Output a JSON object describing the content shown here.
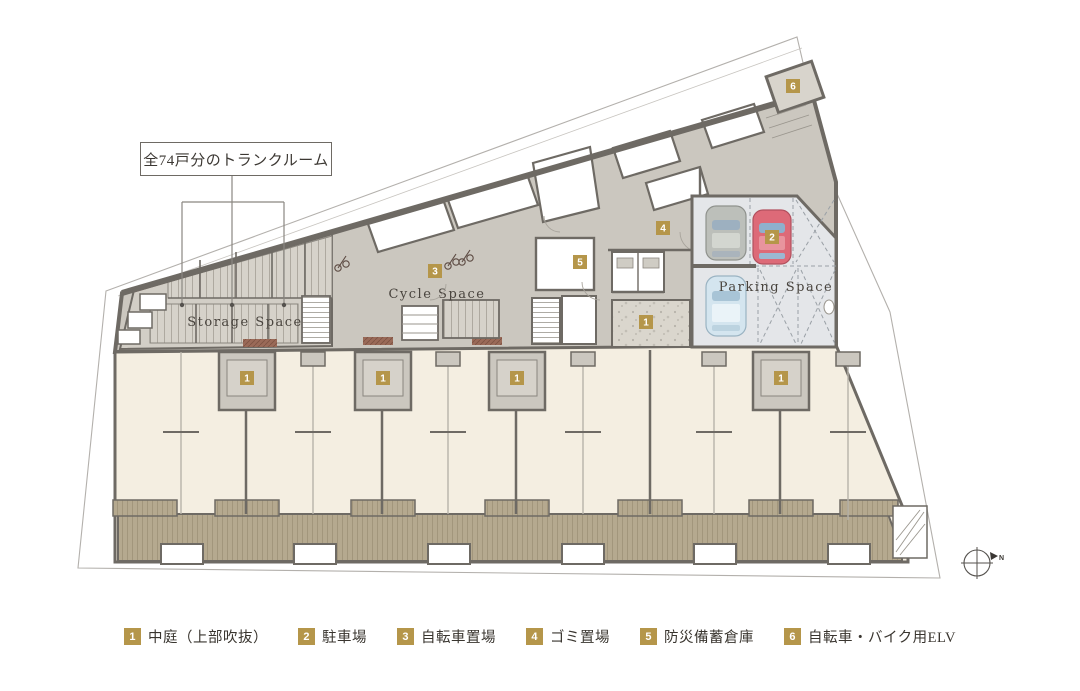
{
  "annotation": {
    "label": "全74戸分のトランクルーム"
  },
  "areas": {
    "storage": "Storage Space",
    "cycle": "Cycle Space",
    "parking": "Parking Space"
  },
  "markers": {
    "courtyard_main": "1",
    "unit_courtyard": "1",
    "parking": "2",
    "cycle": "3",
    "garbage": "4",
    "disaster": "5",
    "elv": "6"
  },
  "legend": {
    "items": [
      {
        "num": "1",
        "label": "中庭（上部吹抜）"
      },
      {
        "num": "2",
        "label": "駐車場"
      },
      {
        "num": "3",
        "label": "自転車置場"
      },
      {
        "num": "4",
        "label": "ゴミ置場"
      },
      {
        "num": "5",
        "label": "防災備蓄倉庫"
      },
      {
        "num": "6",
        "label": "自転車・バイク用ELV"
      }
    ]
  },
  "compass": {
    "label": "N"
  },
  "colors": {
    "badge_gold": "#b5964a",
    "wall": "#6e6a64",
    "circulation_floor": "#cbc7bf",
    "residential_cream": "#f4eee1",
    "deck": "#b5a98f",
    "parking_floor": "#e4e6e9",
    "car_red": "#dd6a78",
    "car_blue": "#d4e5ef",
    "car_gray": "#bcbfba"
  }
}
